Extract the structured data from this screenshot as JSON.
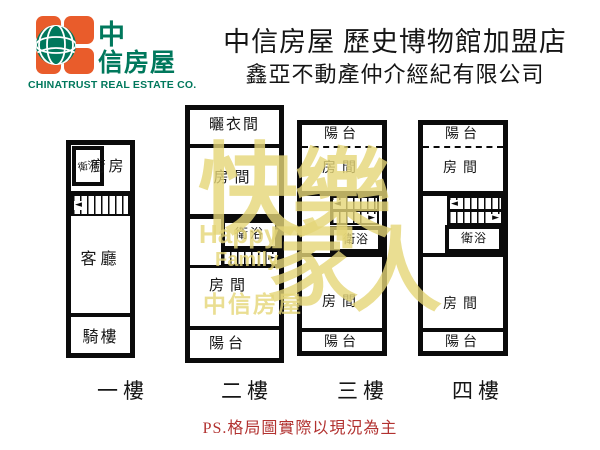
{
  "colors": {
    "wall": "#0b0b0b",
    "brand_orange": "#E95C2B",
    "brand_green": "#00785C",
    "note_red": "#B23230",
    "wm_yellow": "#E5D678"
  },
  "header": {
    "title": "中信房屋 歷史博物館加盟店",
    "subtitle": "鑫亞不動產仲介經紀有限公司",
    "logo": {
      "char_top": "中",
      "char_rest": "信房屋",
      "caption": "CHINATRUST REAL ESTATE CO."
    }
  },
  "floors": [
    {
      "label": "一樓",
      "rooms": {
        "bath": "衛浴",
        "kitchen": "廚房",
        "living": "客廳",
        "arcade": "騎樓"
      }
    },
    {
      "label": "二樓",
      "rooms": {
        "drying": "曬衣間",
        "room_upper": "房間",
        "bath": "衛浴",
        "room_lower": "房間",
        "balcony": "陽台"
      }
    },
    {
      "label": "三樓",
      "rooms": {
        "balcony_top": "陽台",
        "room_upper": "房間",
        "bath": "衛浴",
        "room_lower": "房間",
        "balcony_bottom": "陽台"
      }
    },
    {
      "label": "四樓",
      "rooms": {
        "balcony_top": "陽台",
        "room_upper": "房間",
        "bath": "衛浴",
        "room_lower": "房間",
        "balcony_bottom": "陽台"
      }
    }
  ],
  "watermark": {
    "char_1": "快",
    "char_2": "樂",
    "char_3": "家",
    "char_4": "人",
    "word_1": "Happy",
    "word_2": "Family",
    "brand": "中信房屋"
  },
  "footer": {
    "note": "PS.格局圖實際以現況為主"
  }
}
